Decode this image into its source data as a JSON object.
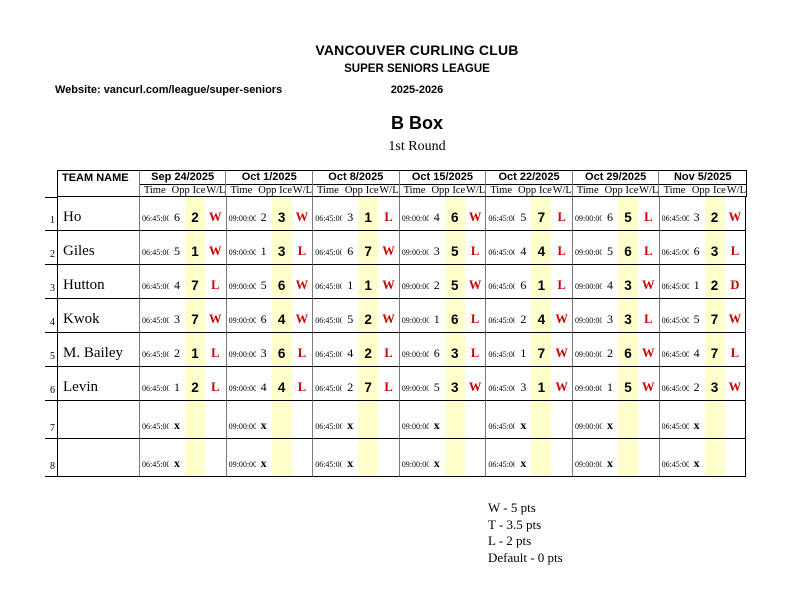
{
  "page": {
    "club": "VANCOUVER CURLING CLUB",
    "league": "SUPER SENIORS LEAGUE",
    "website": "Website: vancurl.com/league/super-seniors",
    "season": "2025-2026",
    "box_title": "B Box",
    "round": "1st Round"
  },
  "table": {
    "team_header": "TEAM NAME",
    "dates": [
      "Sep 24/2025",
      "Oct 1/2025",
      "Oct 8/2025",
      "Oct 15/2025",
      "Oct 22/2025",
      "Oct 29/2025",
      "Nov 5/2025"
    ],
    "sub_headers": [
      "Time",
      "Opp",
      "Ice",
      "W/L"
    ],
    "rows": [
      {
        "num": "1",
        "team": "Ho",
        "games": [
          {
            "time": "06:45:00",
            "opp": "6",
            "ice": "2",
            "wl": "W"
          },
          {
            "time": "09:00:00",
            "opp": "2",
            "ice": "3",
            "wl": "W"
          },
          {
            "time": "06:45:00",
            "opp": "3",
            "ice": "1",
            "wl": "L"
          },
          {
            "time": "09:00:00",
            "opp": "4",
            "ice": "6",
            "wl": "W"
          },
          {
            "time": "06:45:00",
            "opp": "5",
            "ice": "7",
            "wl": "L"
          },
          {
            "time": "09:00:00",
            "opp": "6",
            "ice": "5",
            "wl": "L"
          },
          {
            "time": "06:45:00",
            "opp": "3",
            "ice": "2",
            "wl": "W"
          }
        ]
      },
      {
        "num": "2",
        "team": "Giles",
        "games": [
          {
            "time": "06:45:00",
            "opp": "5",
            "ice": "1",
            "wl": "W"
          },
          {
            "time": "09:00:00",
            "opp": "1",
            "ice": "3",
            "wl": "L"
          },
          {
            "time": "06:45:00",
            "opp": "6",
            "ice": "7",
            "wl": "W"
          },
          {
            "time": "09:00:00",
            "opp": "3",
            "ice": "5",
            "wl": "L"
          },
          {
            "time": "06:45:00",
            "opp": "4",
            "ice": "4",
            "wl": "L"
          },
          {
            "time": "09:00:00",
            "opp": "5",
            "ice": "6",
            "wl": "L"
          },
          {
            "time": "06:45:00",
            "opp": "6",
            "ice": "3",
            "wl": "L"
          }
        ]
      },
      {
        "num": "3",
        "team": "Hutton",
        "games": [
          {
            "time": "06:45:00",
            "opp": "4",
            "ice": "7",
            "wl": "L"
          },
          {
            "time": "09:00:00",
            "opp": "5",
            "ice": "6",
            "wl": "W"
          },
          {
            "time": "06:45:00",
            "opp": "1",
            "ice": "1",
            "wl": "W"
          },
          {
            "time": "09:00:00",
            "opp": "2",
            "ice": "5",
            "wl": "W"
          },
          {
            "time": "06:45:00",
            "opp": "6",
            "ice": "1",
            "wl": "L"
          },
          {
            "time": "09:00:00",
            "opp": "4",
            "ice": "3",
            "wl": "W"
          },
          {
            "time": "06:45:00",
            "opp": "1",
            "ice": "2",
            "wl": "D"
          }
        ]
      },
      {
        "num": "4",
        "team": "Kwok",
        "games": [
          {
            "time": "06:45:00",
            "opp": "3",
            "ice": "7",
            "wl": "W"
          },
          {
            "time": "09:00:00",
            "opp": "6",
            "ice": "4",
            "wl": "W"
          },
          {
            "time": "06:45:00",
            "opp": "5",
            "ice": "2",
            "wl": "W"
          },
          {
            "time": "09:00:00",
            "opp": "1",
            "ice": "6",
            "wl": "L"
          },
          {
            "time": "06:45:00",
            "opp": "2",
            "ice": "4",
            "wl": "W"
          },
          {
            "time": "09:00:00",
            "opp": "3",
            "ice": "3",
            "wl": "L"
          },
          {
            "time": "06:45:00",
            "opp": "5",
            "ice": "7",
            "wl": "W"
          }
        ]
      },
      {
        "num": "5",
        "team": "M. Bailey",
        "games": [
          {
            "time": "06:45:00",
            "opp": "2",
            "ice": "1",
            "wl": "L"
          },
          {
            "time": "09:00:00",
            "opp": "3",
            "ice": "6",
            "wl": "L"
          },
          {
            "time": "06:45:00",
            "opp": "4",
            "ice": "2",
            "wl": "L"
          },
          {
            "time": "09:00:00",
            "opp": "6",
            "ice": "3",
            "wl": "L"
          },
          {
            "time": "06:45:00",
            "opp": "1",
            "ice": "7",
            "wl": "W"
          },
          {
            "time": "09:00:00",
            "opp": "2",
            "ice": "6",
            "wl": "W"
          },
          {
            "time": "06:45:00",
            "opp": "4",
            "ice": "7",
            "wl": "L"
          }
        ]
      },
      {
        "num": "6",
        "team": "Levin",
        "games": [
          {
            "time": "06:45:00",
            "opp": "1",
            "ice": "2",
            "wl": "L"
          },
          {
            "time": "09:00:00",
            "opp": "4",
            "ice": "4",
            "wl": "L"
          },
          {
            "time": "06:45:00",
            "opp": "2",
            "ice": "7",
            "wl": "L"
          },
          {
            "time": "09:00:00",
            "opp": "5",
            "ice": "3",
            "wl": "W"
          },
          {
            "time": "06:45:00",
            "opp": "3",
            "ice": "1",
            "wl": "W"
          },
          {
            "time": "09:00:00",
            "opp": "1",
            "ice": "5",
            "wl": "W"
          },
          {
            "time": "06:45:00",
            "opp": "2",
            "ice": "3",
            "wl": "W"
          }
        ]
      },
      {
        "num": "7",
        "team": "",
        "games": [
          {
            "time": "06:45:00",
            "opp": "x",
            "ice": "",
            "wl": ""
          },
          {
            "time": "09:00:00",
            "opp": "x",
            "ice": "",
            "wl": ""
          },
          {
            "time": "06:45:00",
            "opp": "x",
            "ice": "",
            "wl": ""
          },
          {
            "time": "09:00:00",
            "opp": "x",
            "ice": "",
            "wl": ""
          },
          {
            "time": "06:45:00",
            "opp": "x",
            "ice": "",
            "wl": ""
          },
          {
            "time": "09:00:00",
            "opp": "x",
            "ice": "",
            "wl": ""
          },
          {
            "time": "06:45:00",
            "opp": "x",
            "ice": "",
            "wl": ""
          }
        ]
      },
      {
        "num": "8",
        "team": "",
        "games": [
          {
            "time": "06:45:00",
            "opp": "x",
            "ice": "",
            "wl": ""
          },
          {
            "time": "09:00:00",
            "opp": "x",
            "ice": "",
            "wl": ""
          },
          {
            "time": "06:45:00",
            "opp": "x",
            "ice": "",
            "wl": ""
          },
          {
            "time": "09:00:00",
            "opp": "x",
            "ice": "",
            "wl": ""
          },
          {
            "time": "06:45:00",
            "opp": "x",
            "ice": "",
            "wl": ""
          },
          {
            "time": "09:00:00",
            "opp": "x",
            "ice": "",
            "wl": ""
          },
          {
            "time": "06:45:00",
            "opp": "x",
            "ice": "",
            "wl": ""
          }
        ]
      }
    ]
  },
  "legend": {
    "items": [
      "W - 5 pts",
      "T - 3.5 pts",
      "L - 2 pts",
      "Default - 0 pts"
    ]
  },
  "colors": {
    "result_red": "#cc0000",
    "ice_highlight": "#ffffcc"
  }
}
